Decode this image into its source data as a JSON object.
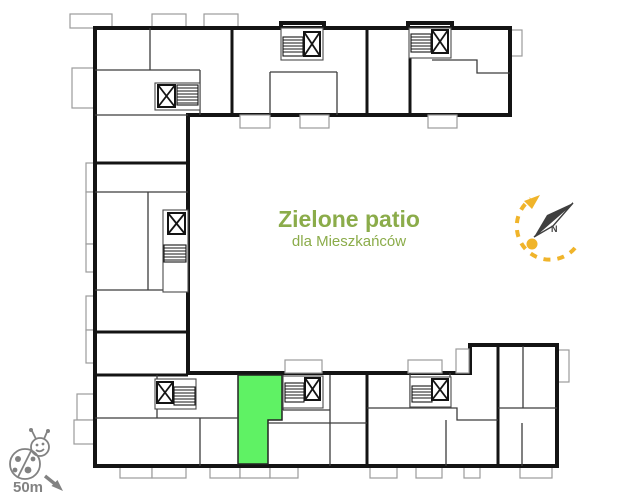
{
  "patio": {
    "title": "Zielone patio",
    "subtitle": "dla Mieszkańców"
  },
  "compass": {
    "north_label": "N"
  },
  "scale": {
    "label": "50m"
  },
  "colors": {
    "highlight_green": "#5FF264",
    "title_green": "#8BAC4A",
    "accent_yellow": "#F0B42A",
    "icon_gray": "#828282",
    "wall_black": "#141414",
    "balcony_gray": "#9B9B9B"
  },
  "icons": {
    "ladybug_icon": "🐞",
    "north_arrow_icon": "compass-needle",
    "route_arrow_icon": "dashed-curved-arrow",
    "scale_arrow_icon": "↘",
    "elevator_icon": "box-with-x",
    "stairs_icon": "ladder-hatch"
  }
}
